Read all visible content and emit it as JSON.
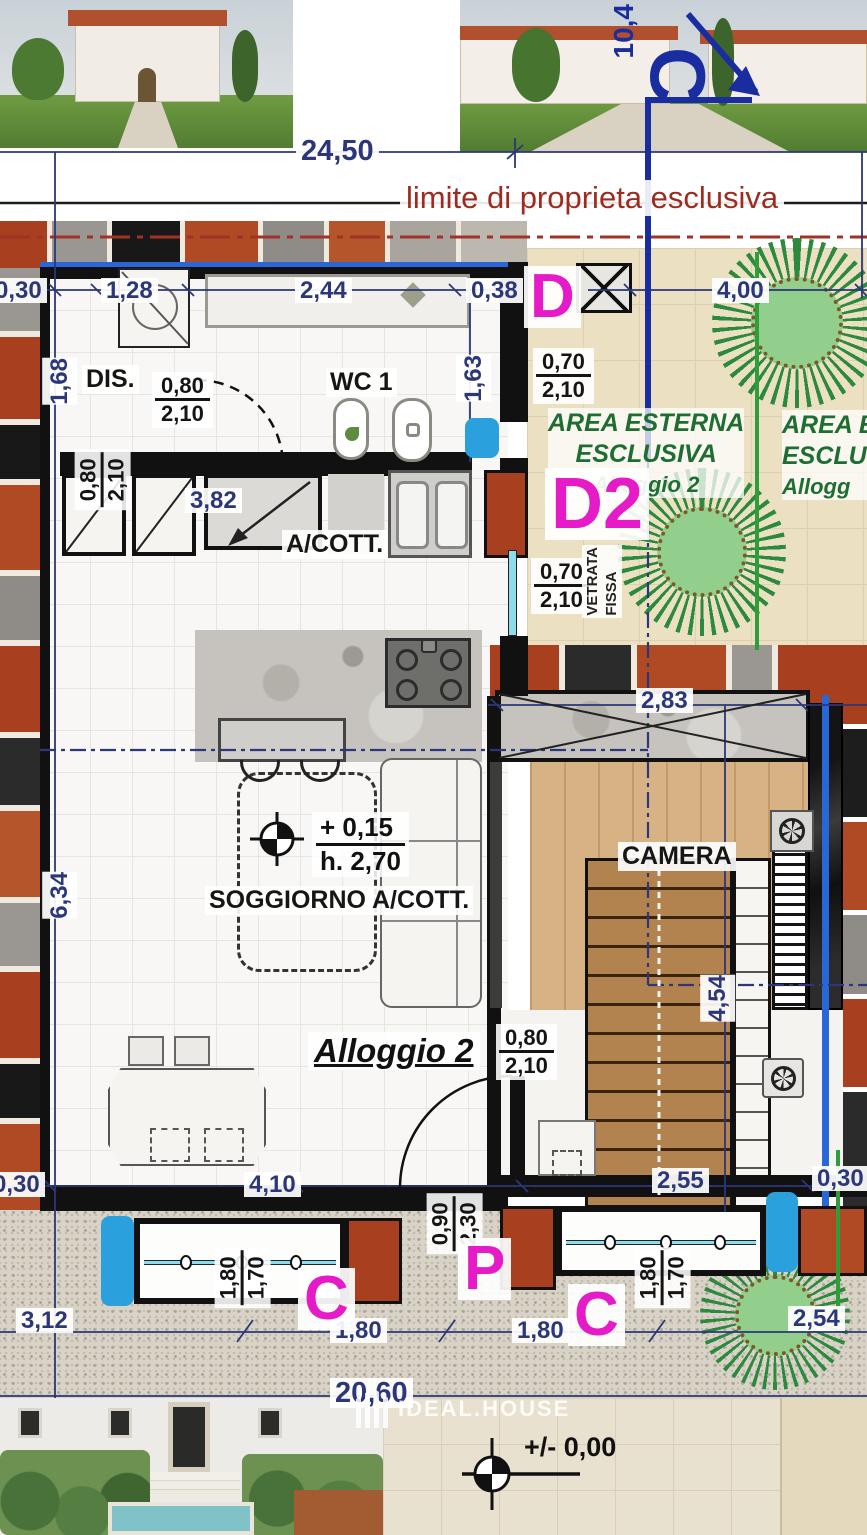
{
  "palette": {
    "dim_blue": "#2b3778",
    "section_blue": "#1a2da0",
    "marker_magenta": "#e51bc7",
    "boundary_red": "#9c2c20",
    "area_green": "#1d6e30",
    "boundary_green_line": "#2f9e38",
    "glass_cyan": "#8edceb",
    "pillar_blue": "#2aa0dd",
    "terracotta": "#a8401f",
    "wood": "#d7b285",
    "stair_brown": "#b3834f"
  },
  "top": {
    "dim_total": "24,50",
    "dim_right_vertical": "10,4",
    "section_c": "C",
    "boundary_label": "limite di proprieta esclusiva"
  },
  "dims_top_row": {
    "a": "0,30",
    "b": "1,28",
    "c": "2,44",
    "d": "0,38",
    "e": "4,00"
  },
  "markers": {
    "d": "D",
    "d2": "D2",
    "p": "P",
    "c_left": "C",
    "c_right": "C"
  },
  "dims_vertical": {
    "left_168": "1,68",
    "left_634": "6,34",
    "right_163": "1,63",
    "right_454": "4,54"
  },
  "doors": {
    "dis": {
      "w": "0,80",
      "h": "2,10"
    },
    "left": {
      "w": "0,80",
      "h": "2,10"
    },
    "camera": {
      "w": "0,80",
      "h": "2,10"
    },
    "entrance": {
      "w": "0,90",
      "h": "2,30"
    }
  },
  "windows": {
    "east_top": {
      "w": "0,70",
      "h": "2,10"
    },
    "east_vetrata": {
      "w": "0,70",
      "h": "2,10",
      "label_1": "VETRATA",
      "label_2": "FISSA"
    },
    "south_left": {
      "w": "1,80",
      "h": "1,70"
    },
    "south_right": {
      "w": "1,80",
      "h": "1,70"
    }
  },
  "rooms": {
    "dis": "DIS.",
    "wc": "WC 1",
    "acott": "A/COTT.",
    "soggiorno": "SOGGIORNO A/COTT.",
    "camera": "CAMERA",
    "alloggio": "Alloggio 2"
  },
  "area_esterna_1": {
    "line1": "AREA ESTERNA",
    "line2": "ESCLUSIVA",
    "line3": "Alloggio 2"
  },
  "area_esterna_2": {
    "line1": "AREA ES",
    "line2": "ESCLU",
    "line3": "Allogg"
  },
  "levels": {
    "floor": "+ 0,15",
    "height": "h. 2,70",
    "ground": "+/- 0,00"
  },
  "dims_mid": {
    "d382": "3,82",
    "d283": "2,83"
  },
  "dims_bottom_row1": {
    "a": "0,30",
    "b": "4,10",
    "c": "2,55",
    "d": "0,30"
  },
  "dims_bottom_row2": {
    "a": "3,12",
    "b": "1,80",
    "c": "1,80",
    "d": "2,54"
  },
  "dims_bottom_total": "20,60",
  "watermark": "IDEAL.HOUSE"
}
